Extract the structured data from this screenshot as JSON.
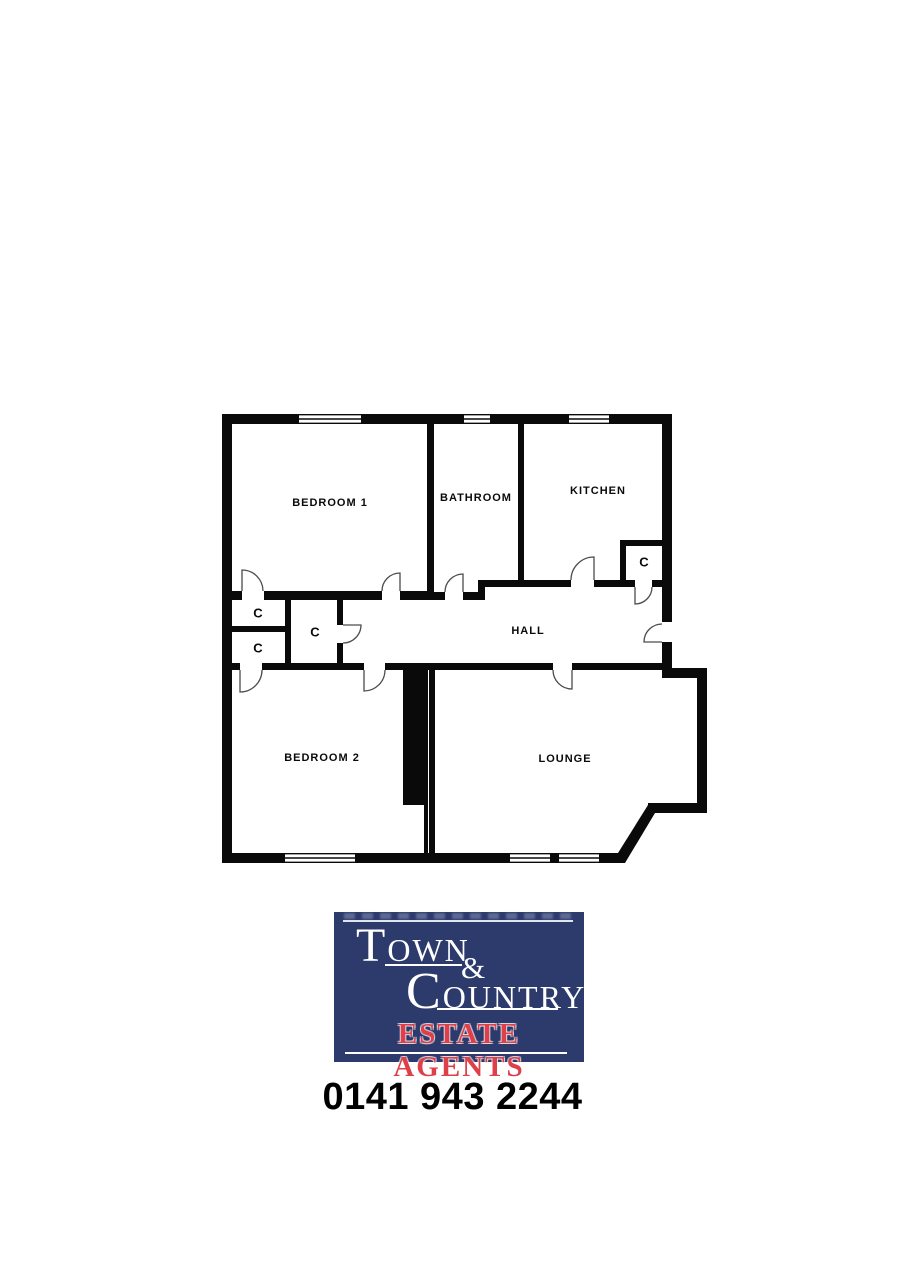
{
  "floorplan": {
    "rooms": {
      "bedroom1": "BEDROOM 1",
      "bathroom": "BATHROOM",
      "kitchen": "KITCHEN",
      "hall": "HALL",
      "bedroom2": "BEDROOM 2",
      "lounge": "LOUNGE"
    },
    "cupboard_label": "C",
    "wall_color": "#0a0a0a"
  },
  "branding": {
    "logo": {
      "background": "#2c3a6c",
      "line1": {
        "initial": "T",
        "rest": "OWN"
      },
      "ampersand": "&",
      "line2": {
        "initial": "C",
        "rest": "OUNTRY"
      },
      "tagline": "ESTATE AGENTS",
      "text_color": "#ffffff",
      "tagline_color": "#df3f49"
    },
    "phone": "0141 943 2244"
  }
}
